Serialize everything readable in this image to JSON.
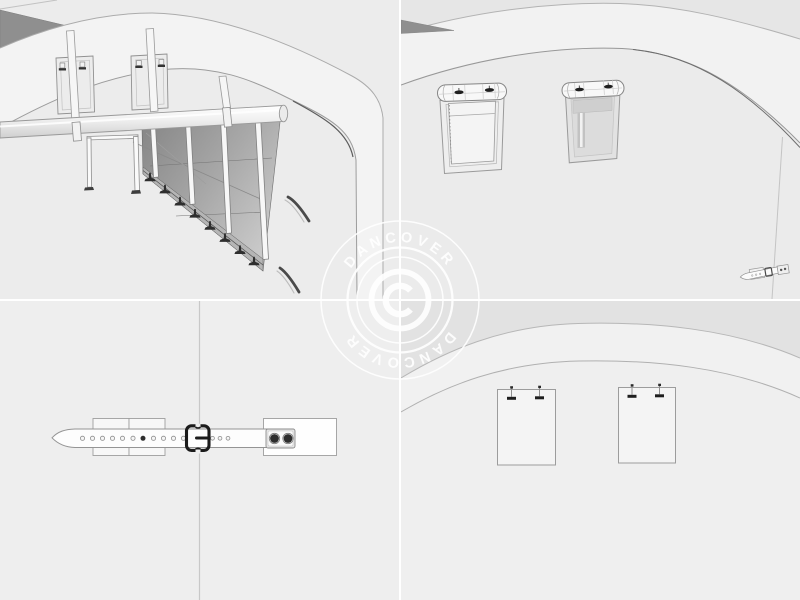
{
  "watermark": {
    "brand_top": "DANCOVER",
    "brand_bottom": "DANCOVER",
    "copyright_symbol": "©",
    "color": "#ffffff"
  },
  "gallery": {
    "grid": "2x2",
    "panels": [
      {
        "id": "top-left",
        "subject": "tent-interior-frame-straps-and-ground-anchors"
      },
      {
        "id": "top-right",
        "subject": "tent-side-wall-with-two-roll-up-windows"
      },
      {
        "id": "bottom-left",
        "subject": "strap-and-buckle-fastener-detail"
      },
      {
        "id": "bottom-right",
        "subject": "tent-gable-wall-with-two-cover-panels"
      }
    ]
  },
  "colors": {
    "canvas": "#ececec",
    "shaded_sky": "#e2e2e2",
    "roof_band": "#f3f3f3",
    "outline": "#9a9a9a",
    "dark_roof_wedge": "#8f8f8f",
    "dark_hardware": "#2e2e2e",
    "divider": "#ffffff",
    "watermark": "#ffffff"
  }
}
